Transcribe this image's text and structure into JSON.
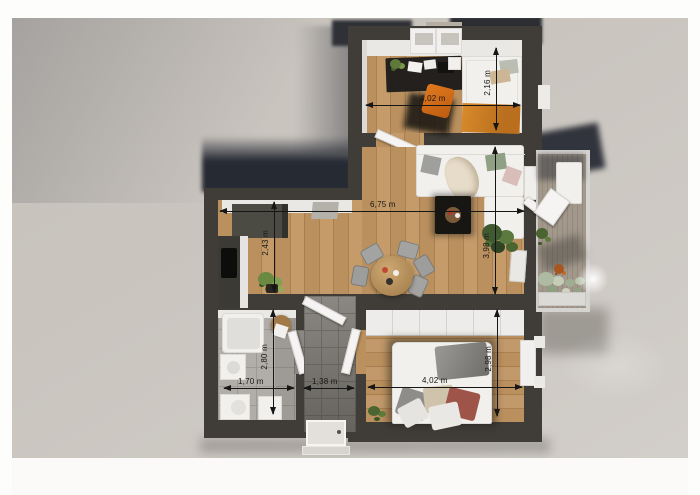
{
  "title": "apartment-floor-plan-3d-top-view",
  "rooms": {
    "office": {
      "width_label": "4,02 m",
      "depth_label": "2,16 m"
    },
    "living": {
      "width_label": "6,75 m",
      "depth_label": "3,98 m"
    },
    "kitchen": {
      "depth_label": "2,43 m"
    },
    "bathroom": {
      "width_label": "1,70 m",
      "depth_label": "2,80 m"
    },
    "hallway": {
      "width_label": "1,38 m"
    },
    "bedroom": {
      "width_label": "4,02 m",
      "depth_label": "2,98 m"
    }
  },
  "colors": {
    "background": "#cac5bf",
    "wall": "#403c38",
    "wood_floor": "#b58a58",
    "cast_shadow": "#262a33",
    "accent_orange": "#d98a2b",
    "dimension_line": "#161616"
  }
}
